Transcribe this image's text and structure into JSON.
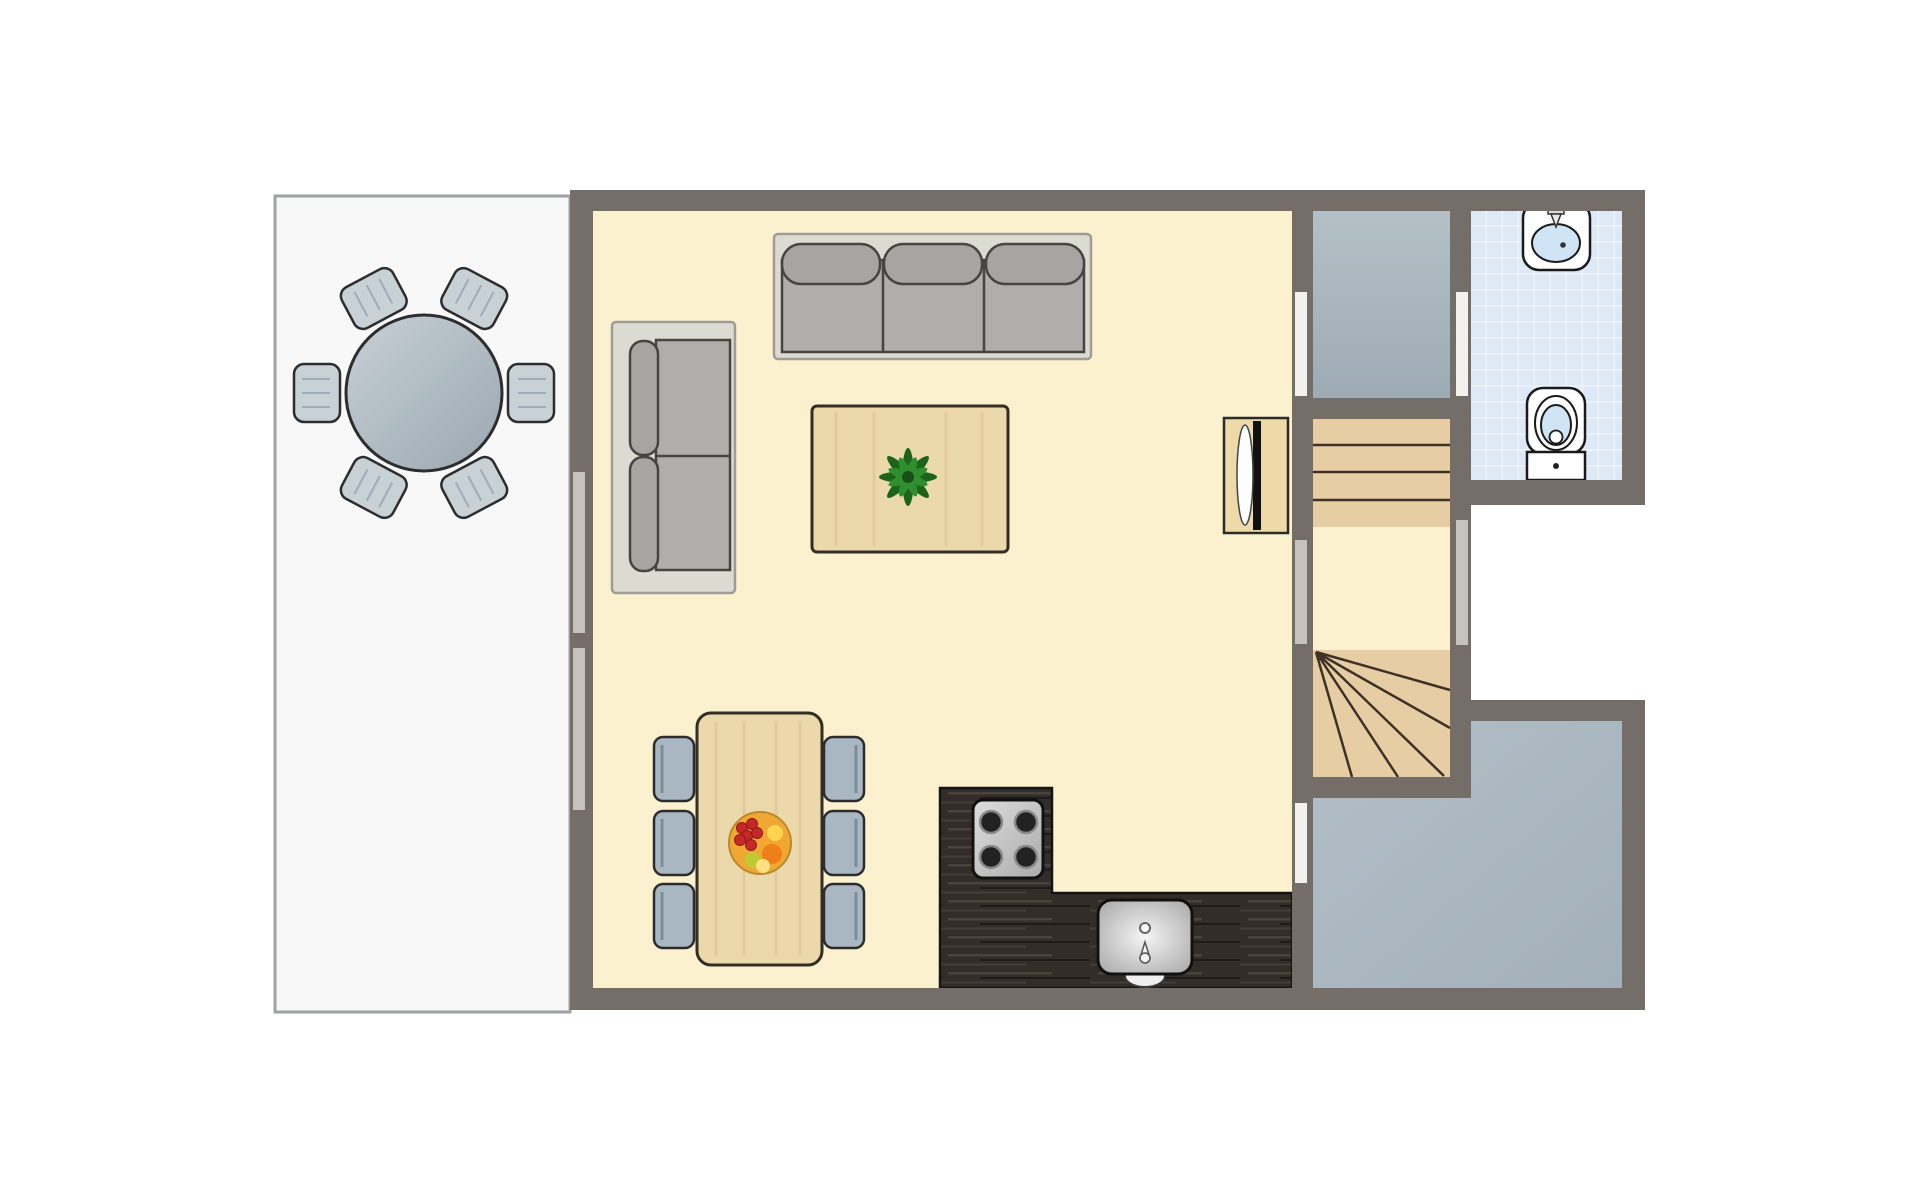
{
  "scene": {
    "type": "floor-plan",
    "view": "top-down",
    "description": "ground-floor apartment plan with terrace, living-dining room, kitchen corner, vestibule, winder staircase, bathroom and utility room"
  },
  "colors": {
    "bg": "#ffffff",
    "wall": "#746d68",
    "living_floor": "#fcf1cf",
    "terrace_tile": "#f8f8f9",
    "terrace_grout": "#d1d3d7",
    "terrace_border": "#9fa1a5",
    "vestibule_floor_a": "#b4c0c6",
    "vestibule_floor_b": "#9dabb4",
    "utility_floor_a": "#b2bfc7",
    "utility_floor_b": "#a2b0ba",
    "bath_floor": "#dde9f4",
    "bath_grid": "#edf3fa",
    "wood_stair": "#e6cda4",
    "stair_line": "#3e3226",
    "sofa_base": "#dcdbd2",
    "sofa_cushion": "#a7a4a1",
    "sofa_seat": "#b0adaa",
    "sofa_outline": "#474441",
    "table_wood": "#ecd9ab",
    "wood_grain": "#d9bf8f",
    "wood_outline": "#332d24",
    "chair_fill": "#a9b7c2",
    "chair_outline": "#2c2c2c",
    "patio_chair": "#c8d1d6",
    "patio_table_a": "#c7d0d5",
    "patio_table_b": "#9aa8b1",
    "patio_outline": "#2d2d2d",
    "counter_wood": "#322d29",
    "counter_streak": "#4a433c",
    "counter_dark": "#1f1b18",
    "appliance": "#d2d2d2",
    "fixture_white": "#ffffff",
    "fixture_blue": "#cfe4f5",
    "fixture_outline": "#1a1a1a",
    "door_white": "#f2f1ef",
    "window_gray": "#c6c2bc",
    "plant_dark": "#1c641c",
    "plant_mid": "#2f8f2f",
    "fruit_bowl": "#f0a832",
    "grape": "#c62828",
    "orange": "#ef7f1a",
    "lemon": "#ffd54f",
    "lime": "#c0ca33"
  },
  "rooms": [
    {
      "id": "terrace",
      "name": "terrace"
    },
    {
      "id": "living-room",
      "name": "living-dining room"
    },
    {
      "id": "kitchen",
      "name": "kitchen corner"
    },
    {
      "id": "vestibule",
      "name": "vestibule"
    },
    {
      "id": "staircase",
      "name": "winder staircase"
    },
    {
      "id": "bathroom",
      "name": "bathroom"
    },
    {
      "id": "utility-room",
      "name": "utility room"
    }
  ],
  "furniture": [
    {
      "id": "patio-table",
      "name": "round patio table with 6 chairs",
      "room": "terrace"
    },
    {
      "id": "sofa-3seat",
      "name": "three-seat sofa",
      "room": "living-room"
    },
    {
      "id": "sofa-2seat",
      "name": "two-seat sofa",
      "room": "living-room"
    },
    {
      "id": "coffee-table",
      "name": "coffee table with potted plant",
      "room": "living-room"
    },
    {
      "id": "dining-table",
      "name": "dining table with 6 chairs and fruit bowl",
      "room": "living-room"
    },
    {
      "id": "sideboard",
      "name": "sideboard cabinet",
      "room": "living-room"
    },
    {
      "id": "counter",
      "name": "L-shaped dark wood counter",
      "room": "kitchen"
    },
    {
      "id": "stove",
      "name": "four-burner stove",
      "room": "kitchen"
    },
    {
      "id": "kitchen-sink",
      "name": "kitchen sink",
      "room": "kitchen"
    },
    {
      "id": "wash-basin",
      "name": "wash basin",
      "room": "bathroom"
    },
    {
      "id": "toilet",
      "name": "toilet",
      "room": "bathroom"
    }
  ],
  "openings": [
    {
      "id": "window-left-1",
      "type": "window",
      "wall": "living-room west"
    },
    {
      "id": "window-left-2",
      "type": "window",
      "wall": "living-room west"
    },
    {
      "id": "door-living-vestibule",
      "type": "door",
      "wall": "living-room east"
    },
    {
      "id": "door-vestibule-bathroom",
      "type": "door",
      "wall": "vestibule east"
    },
    {
      "id": "window-landing-west",
      "type": "window",
      "wall": "stair landing west"
    },
    {
      "id": "window-landing-east",
      "type": "window",
      "wall": "stair landing east"
    },
    {
      "id": "door-kitchen-utility",
      "type": "door",
      "wall": "kitchen east"
    }
  ]
}
